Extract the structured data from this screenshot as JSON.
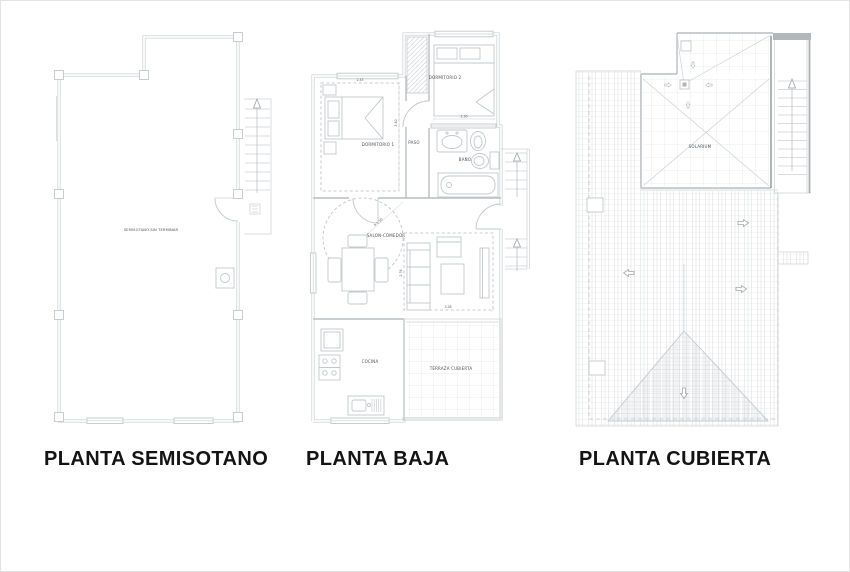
{
  "colors": {
    "background": "#ffffff",
    "wall_line": "#b9bec4",
    "thin_line": "#ccd1d5",
    "dark_accent": "#a8adb2",
    "tiny_text": "#4a4f54",
    "title_text": "#141414"
  },
  "plans": {
    "semisotano": {
      "title": "PLANTA SEMISOTANO",
      "labels": {
        "room": "SEMISOTANO SIN TERMINAR"
      }
    },
    "baja": {
      "title": "PLANTA BAJA",
      "labels": {
        "dormitorio1": "DORMITORIO 1",
        "dormitorio2": "DORMITORIO 2",
        "paso": "PASO",
        "bano": "BAÑO",
        "salon": "SALON-COMEDOR",
        "cocina": "COCINA",
        "terraza": "TERRAZA CUBIERTA"
      },
      "dimensions": {
        "dorm1_width": "2.45",
        "dorm1_depth": "3.40",
        "dorm2_width": "2.30",
        "salon_width": "3.26",
        "salon_depth": "2.76",
        "salon_radius": "R 1.50"
      }
    },
    "cubierta": {
      "title": "PLANTA CUBIERTA",
      "labels": {
        "solarium": "SOLARIUM"
      }
    }
  }
}
